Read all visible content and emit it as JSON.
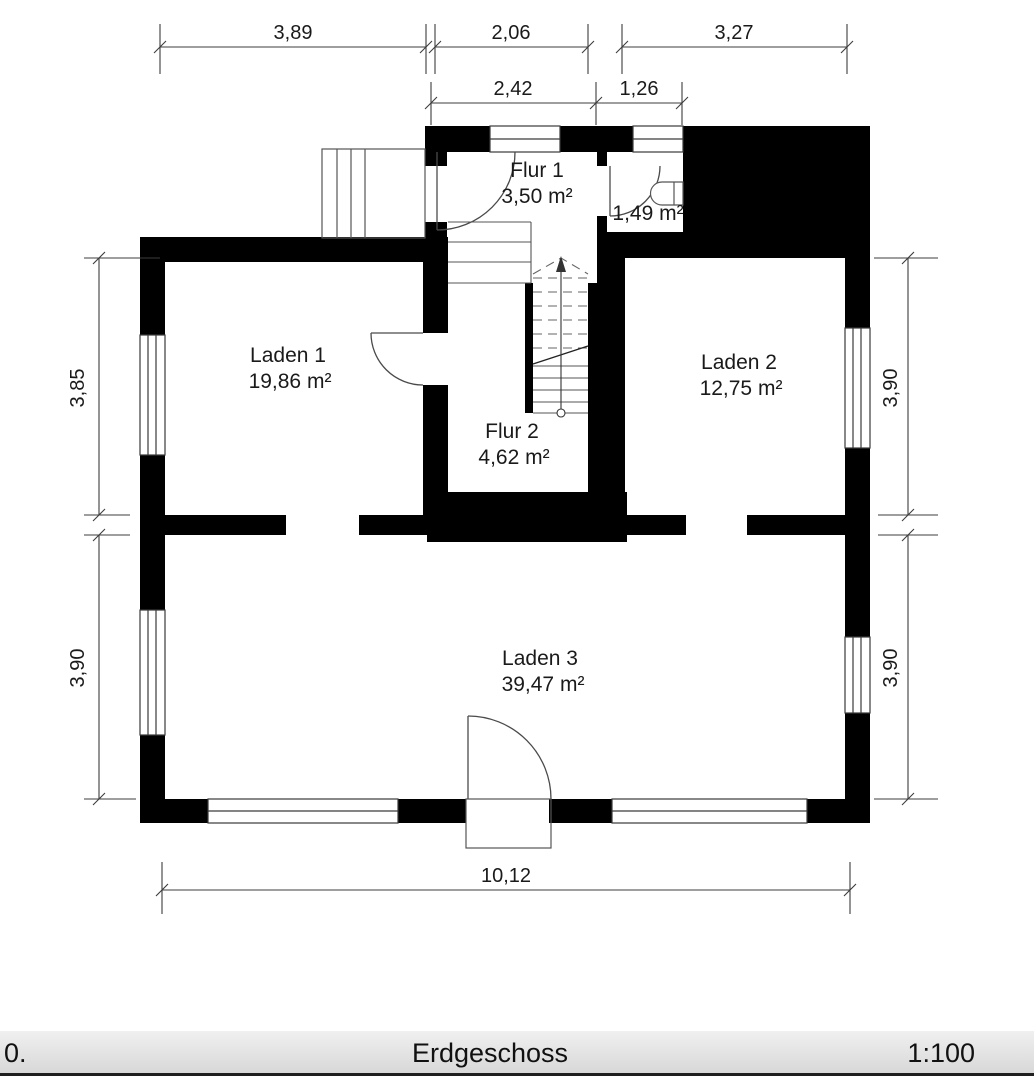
{
  "sheet": {
    "floor_name": "Erdgeschoss",
    "page_label": "0.",
    "scale": "1:100"
  },
  "rooms": {
    "flur1": {
      "name": "Flur 1",
      "area": "3,50 m²"
    },
    "wc": {
      "area": "1,49 m²"
    },
    "laden1": {
      "name": "Laden 1",
      "area": "19,86 m²"
    },
    "laden2": {
      "name": "Laden 2",
      "area": "12,75 m²"
    },
    "flur2": {
      "name": "Flur 2",
      "area": "4,62 m²"
    },
    "laden3": {
      "name": "Laden 3",
      "area": "39,47 m²"
    }
  },
  "dimensions": {
    "top_row1": [
      {
        "label": "3,89"
      },
      {
        "label": "2,06"
      },
      {
        "label": "3,27"
      }
    ],
    "top_row2": [
      {
        "label": "2,42"
      },
      {
        "label": "1,26"
      }
    ],
    "left": [
      {
        "label": "3,85"
      },
      {
        "label": "3,90"
      }
    ],
    "right": [
      {
        "label": "3,90"
      },
      {
        "label": "3,90"
      }
    ],
    "bottom": {
      "label": "10,12"
    }
  },
  "colors": {
    "wall": "#000000",
    "thin_line": "#4a4a4a",
    "stair_line": "#777777",
    "dim_line": "#3c3c3c"
  }
}
